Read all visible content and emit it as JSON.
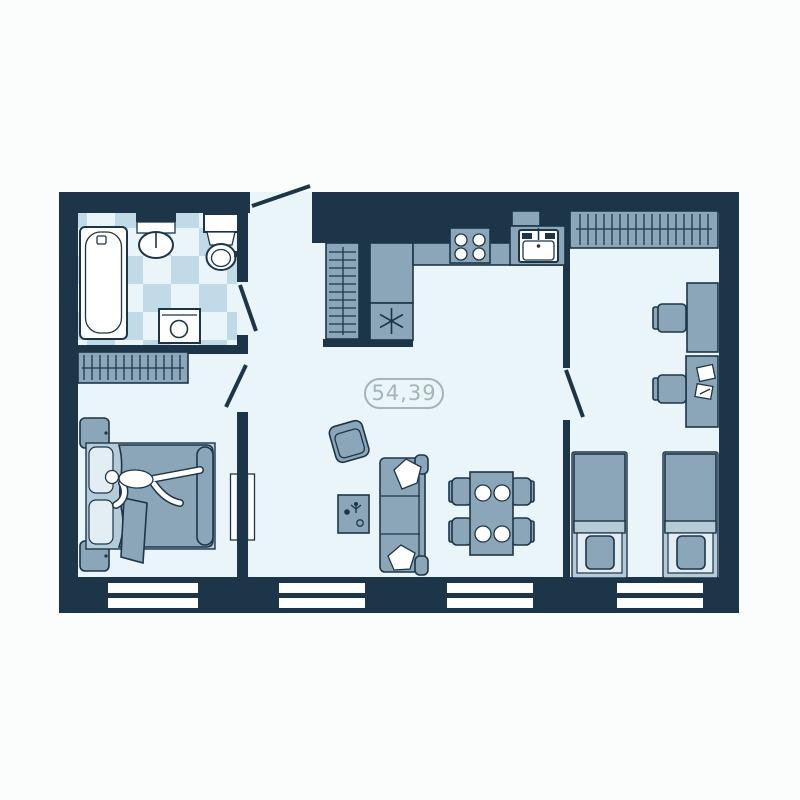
{
  "floorplan": {
    "area_label": "54,39",
    "colors": {
      "background": "#fbfdfd",
      "wall": "#1d3549",
      "floor": "#e9f5f9",
      "tile": "#c0dae7",
      "furniture": "#8ba6b8",
      "furniture_light": "#b6cbd8",
      "sheet": "#e3eef4",
      "fixture": "#ffffff",
      "label": "#a7b3ba"
    },
    "elements": [
      "bathtub",
      "bathroom-sink",
      "toilet",
      "washing-machine",
      "wardrobe",
      "hall-closet",
      "entrance-door",
      "refrigerator",
      "stove",
      "kitchen-sink",
      "kitchen-counter",
      "armchair",
      "coffee-table",
      "sofa",
      "dining-table",
      "dining-chairs",
      "double-bed",
      "person",
      "nightstands",
      "desks",
      "desk-chairs",
      "single-beds",
      "windows",
      "interior-doors"
    ]
  }
}
